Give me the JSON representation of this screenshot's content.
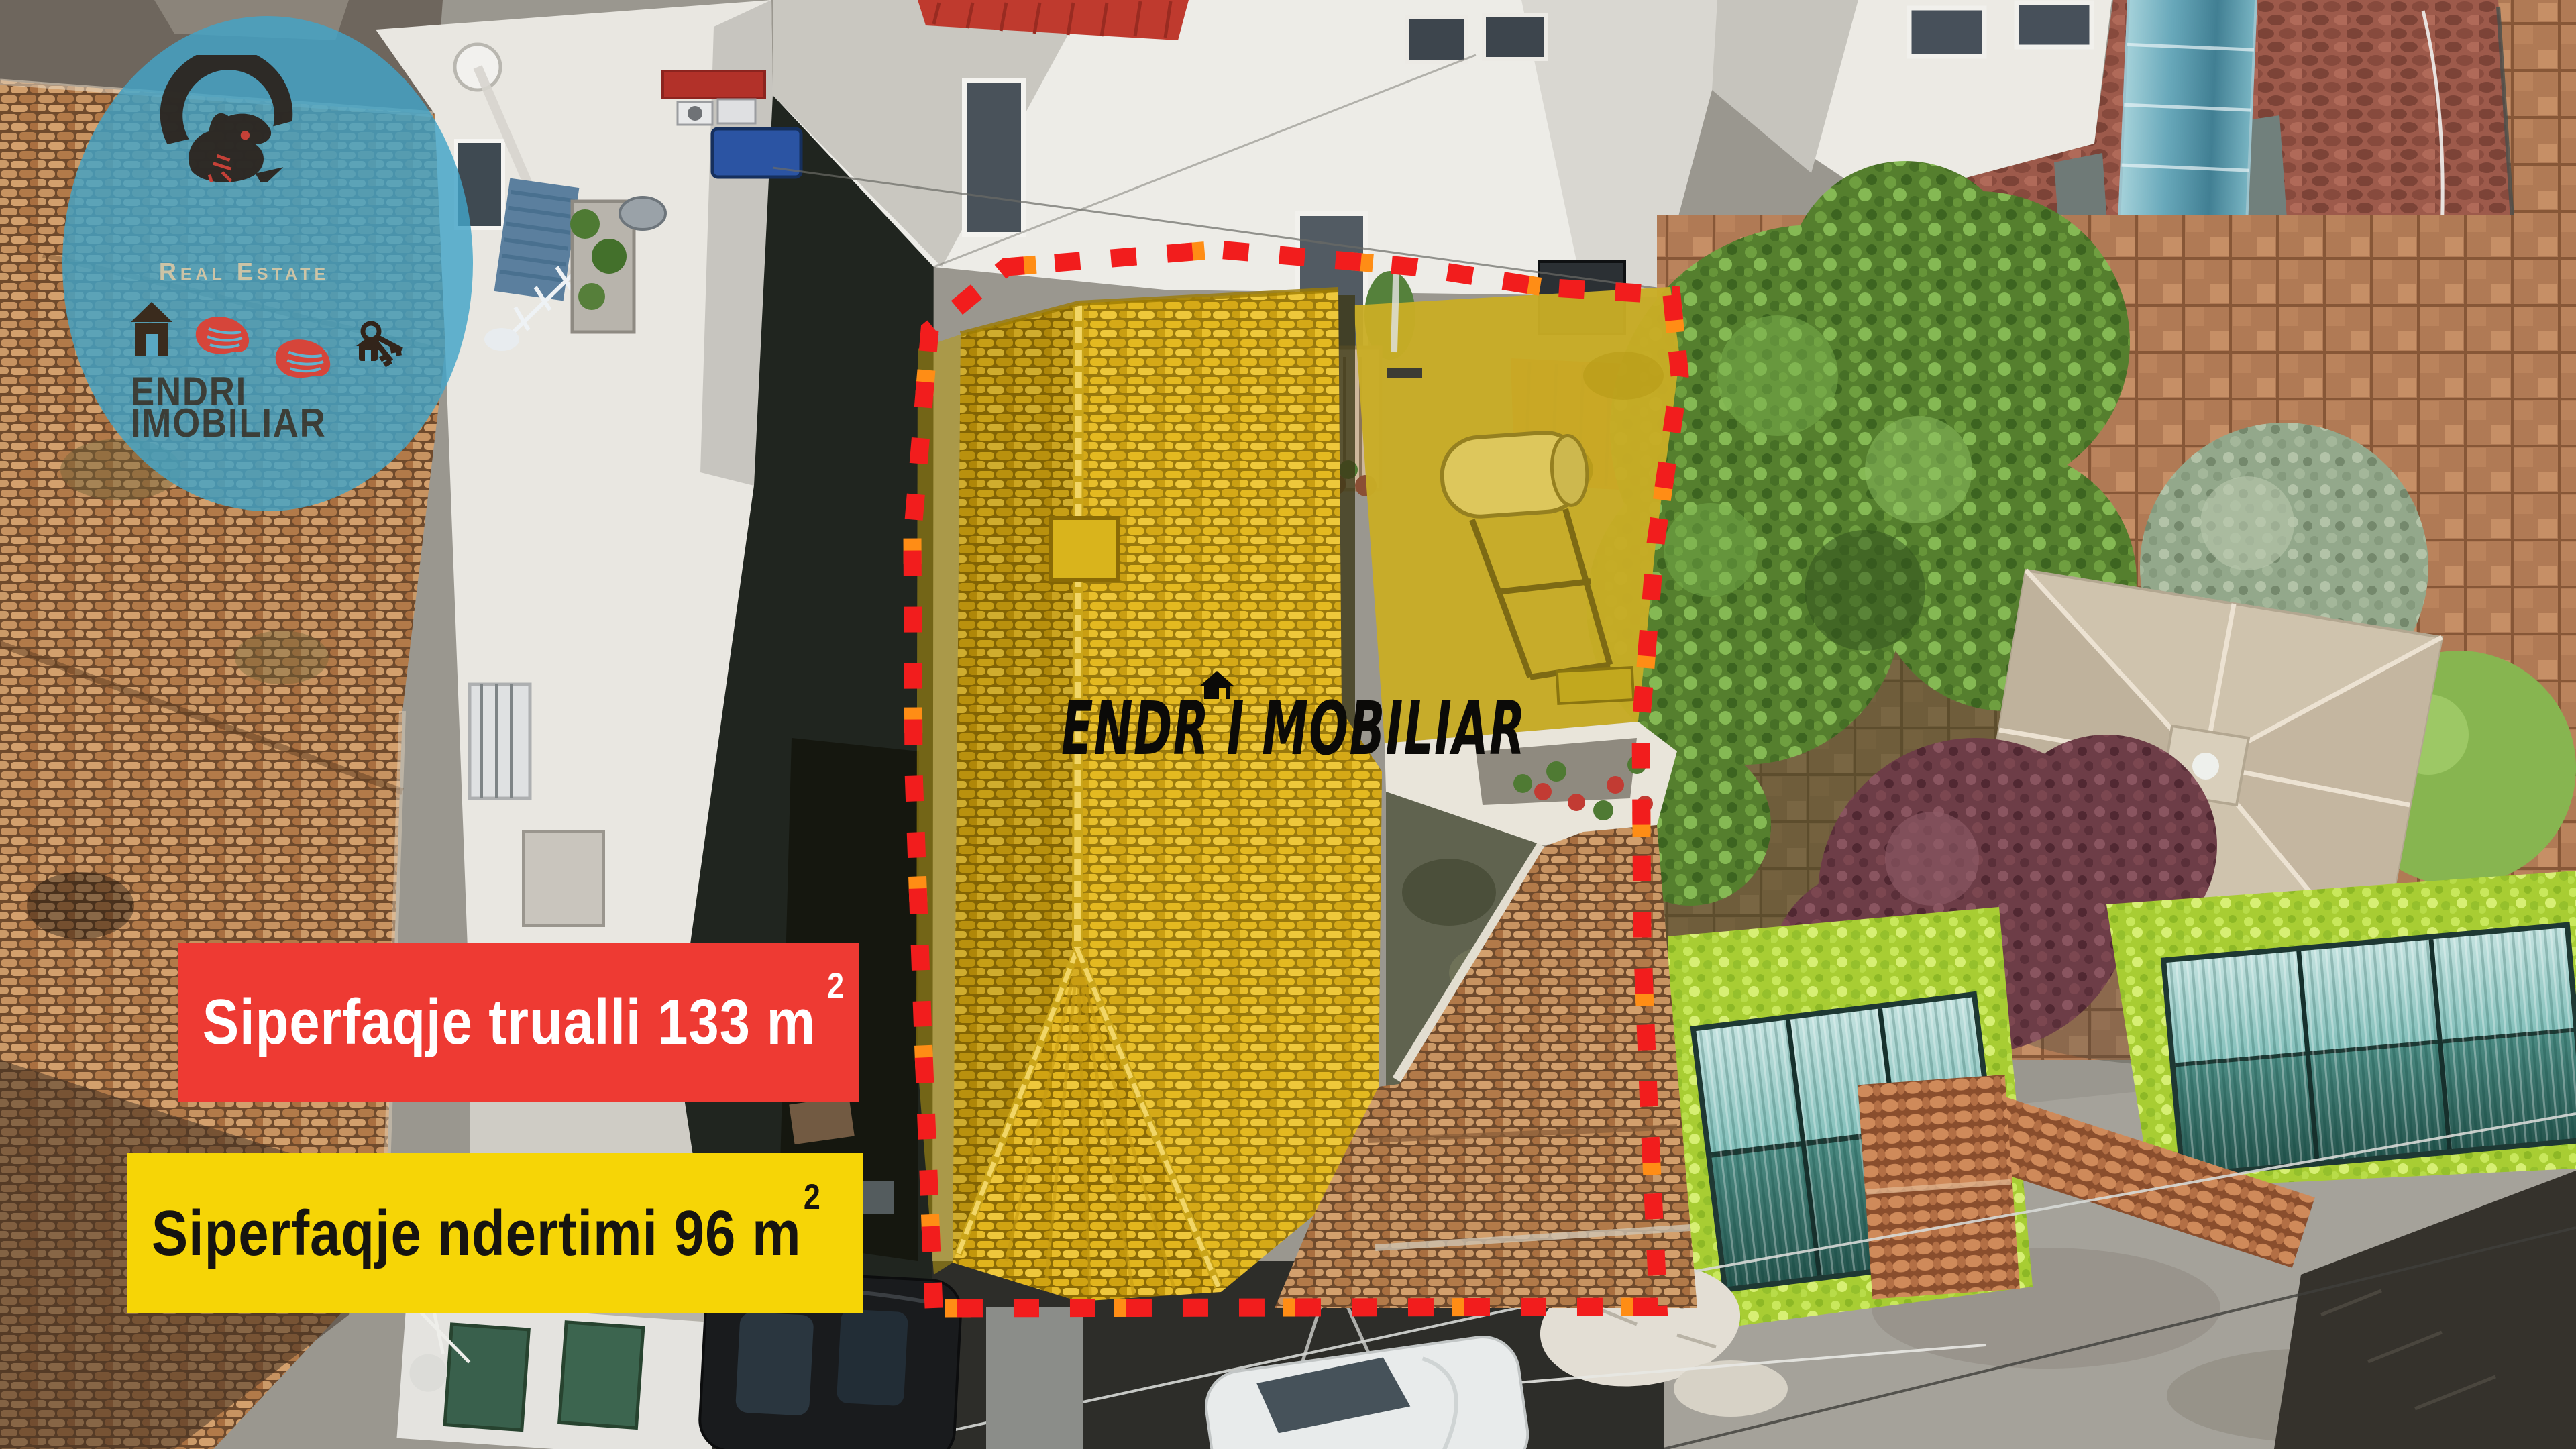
{
  "logo": {
    "tagline": "Real Estate",
    "name_line1": "ENDRI",
    "name_line2": "IMOBILIAR",
    "icons": [
      "ibex-logo-icon",
      "house-icon",
      "hand-icon",
      "hand-icon",
      "keys-icon"
    ]
  },
  "watermark": {
    "text": "ENDR I MOBILIAR",
    "icon": "house-roof-icon"
  },
  "banners": {
    "land": {
      "label": "Siperfaqje trualli",
      "value": "133",
      "unit": "m",
      "sup": "2"
    },
    "building": {
      "label": "Siperfaqje ndertimi",
      "value": "96",
      "unit": "m",
      "sup": "2"
    }
  },
  "colors": {
    "banner_land_bg": "#ee3a33",
    "banner_land_text": "#ffffff",
    "banner_building_bg": "#f6d506",
    "banner_building_text": "#161410",
    "boundary": "#f21d1d",
    "boundary_accent": "#ff8d15",
    "parcel_highlight": "#c9ad25",
    "logo_circle": "rgba(66,163,199,0.82)",
    "watermark_text": "#0b0a08"
  }
}
